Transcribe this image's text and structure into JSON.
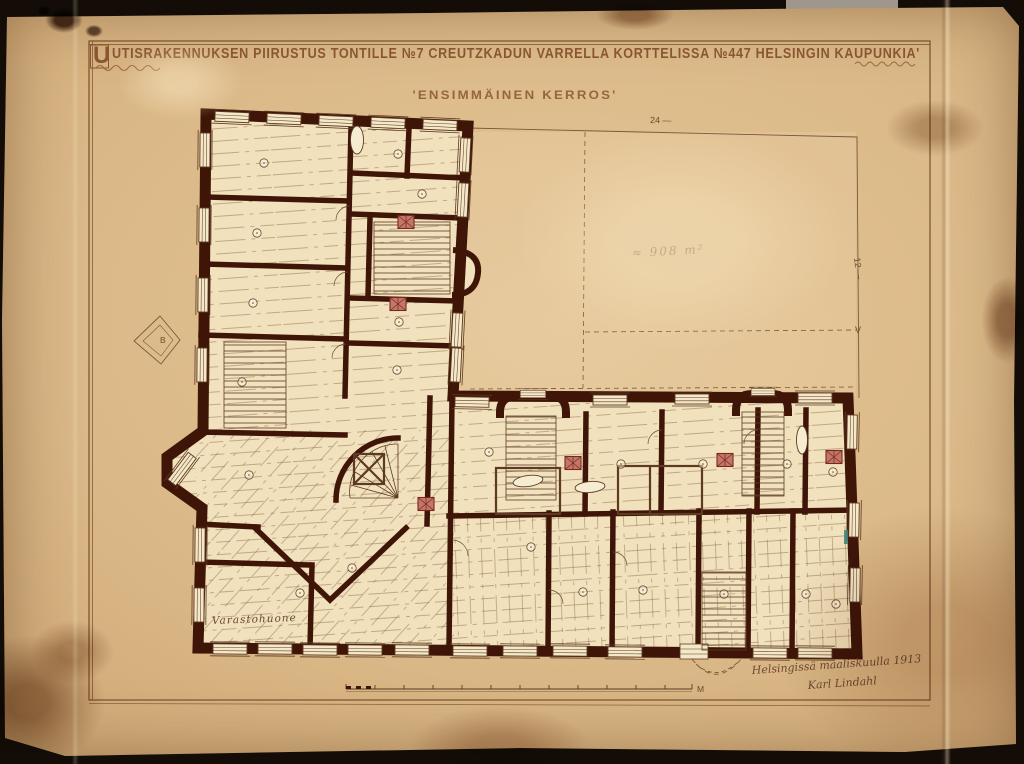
{
  "sheet": {
    "title_initial": "U",
    "title": "UTISRAKENNUKSEN PIIRUSTUS TONTILLE №7 CREUTZKADUN VARRELLA KORTTELISSA №447 HELSINGIN KAUPUNKIA'",
    "subtitle": "'ENSIMMÄINEN KERROS'"
  },
  "plan": {
    "courtyard_area_note": "≈ 908 m²",
    "dim_top": "24 —",
    "dim_right": "12 —",
    "marker_right": "V",
    "marker_left": "B",
    "storage_room_label": "Varastohuone",
    "scale_label": "M"
  },
  "signature": {
    "line1": "Helsingissä maaliskuulla 1913",
    "line2": "Karl Lindahl"
  },
  "colors": {
    "paper": "#dab786",
    "wall_ink": "#3f1508",
    "line_ink": "#6b4a2c",
    "title_ink": "#8a5631",
    "stove_red": "#c4766a"
  }
}
